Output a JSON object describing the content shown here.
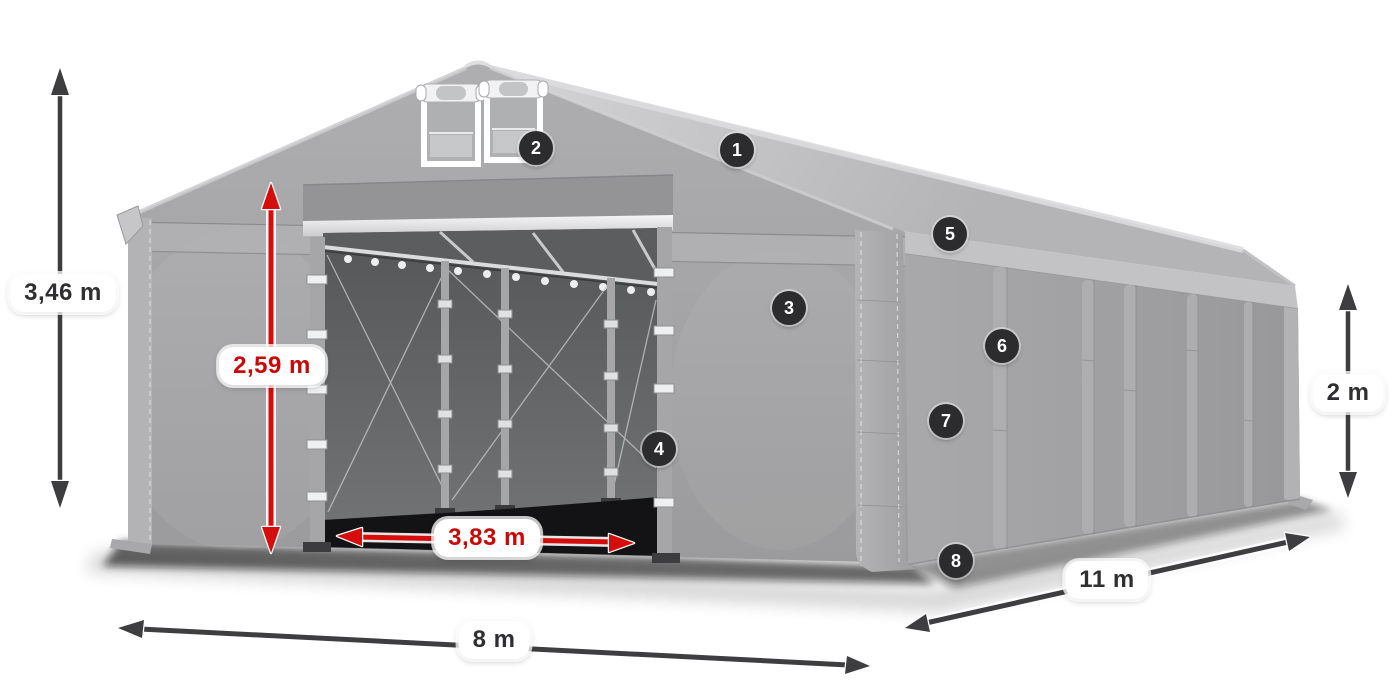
{
  "dimension_labels": {
    "total_height": "3,46 m",
    "door_height": "2,59 m",
    "door_width": "3,83 m",
    "front_width": "8 m",
    "side_length": "11 m",
    "side_height": "2 m"
  },
  "badges": [
    {
      "number": "1"
    },
    {
      "number": "2"
    },
    {
      "number": "3"
    },
    {
      "number": "4"
    },
    {
      "number": "5"
    },
    {
      "number": "6"
    },
    {
      "number": "7"
    },
    {
      "number": "8"
    }
  ],
  "colors": {
    "dimension_red": "#d60d0d",
    "arrow_dark": "#3e3e40",
    "badge_background": "#2c2c2e",
    "badge_text": "#ffffff",
    "label_background": "#ffffff",
    "label_text_dark": "#2f2f31",
    "tent_gray": "#a2a2a4",
    "roof_gray": "#c6c6c8",
    "interior_dark": "#48494b"
  }
}
